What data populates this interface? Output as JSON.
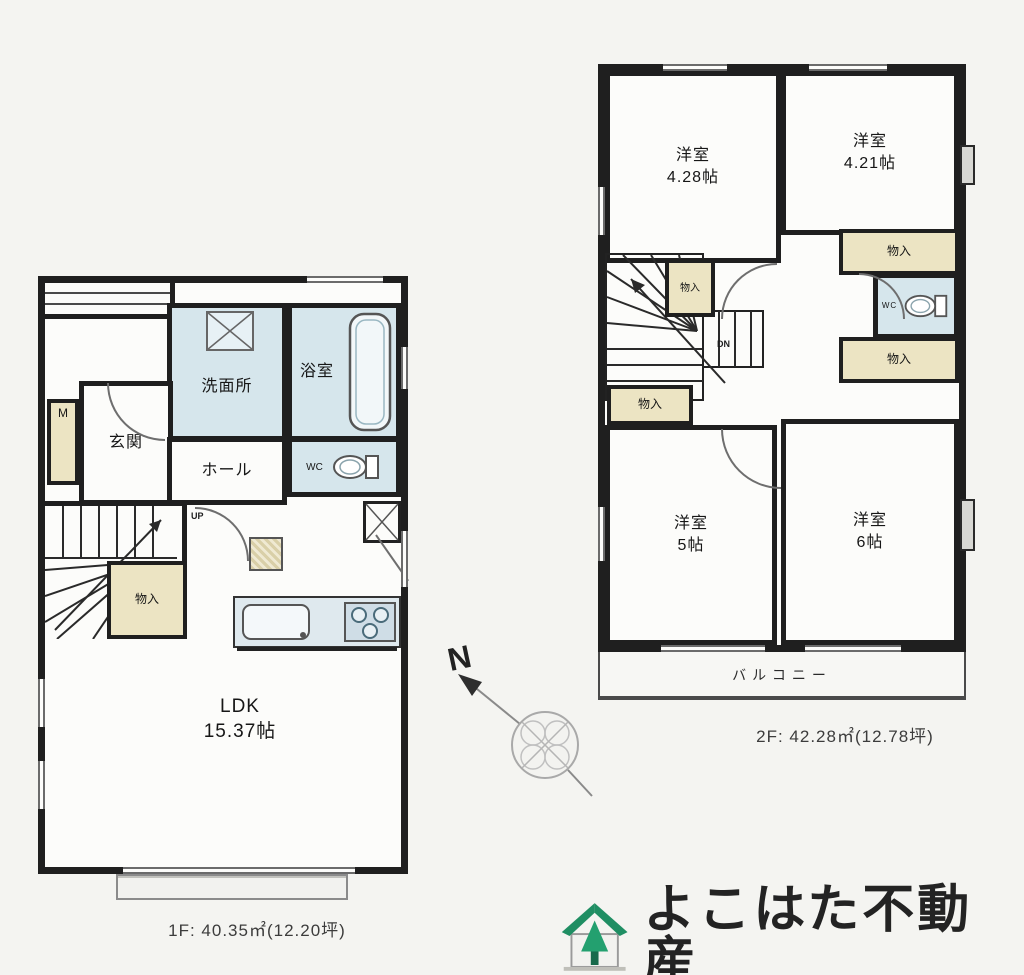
{
  "colors": {
    "wall": "#1f1f1f",
    "wet_room": "#d6e6ec",
    "closet": "#ece4c3",
    "logo_green": "#1f8e63",
    "background": "#f4f4f1"
  },
  "plan_1f": {
    "caption": "1F: 40.35㎡(12.20坪)",
    "stairs_direction": "UP",
    "rooms": {
      "genkan": {
        "label": "玄関"
      },
      "senmenjo": {
        "label": "洗面所"
      },
      "bath": {
        "label": "浴室"
      },
      "hall": {
        "label": "ホール"
      },
      "wc": {
        "label": "WC"
      },
      "closet": {
        "label": "物入"
      },
      "meter": {
        "label": "M"
      },
      "ldk": {
        "label": "LDK",
        "size": "15.37帖"
      }
    }
  },
  "plan_2f": {
    "caption": "2F: 42.28㎡(12.78坪)",
    "stairs_direction": "DN",
    "rooms": {
      "room_nw": {
        "label": "洋室",
        "size": "4.28帖"
      },
      "room_ne": {
        "label": "洋室",
        "size": "4.21帖"
      },
      "room_sw": {
        "label": "洋室",
        "size": "5帖"
      },
      "room_se": {
        "label": "洋室",
        "size": "6帖"
      },
      "closet_stairs": {
        "label": "物入"
      },
      "closet_east_upper": {
        "label": "物入"
      },
      "closet_east_lower": {
        "label": "物入"
      },
      "closet_west": {
        "label": "物入"
      },
      "wc": {
        "label": "WC"
      },
      "balcony": {
        "label": "バルコニー"
      }
    }
  },
  "compass": {
    "north_label": "N"
  },
  "logo": {
    "company_name": "よこはた不動産"
  }
}
